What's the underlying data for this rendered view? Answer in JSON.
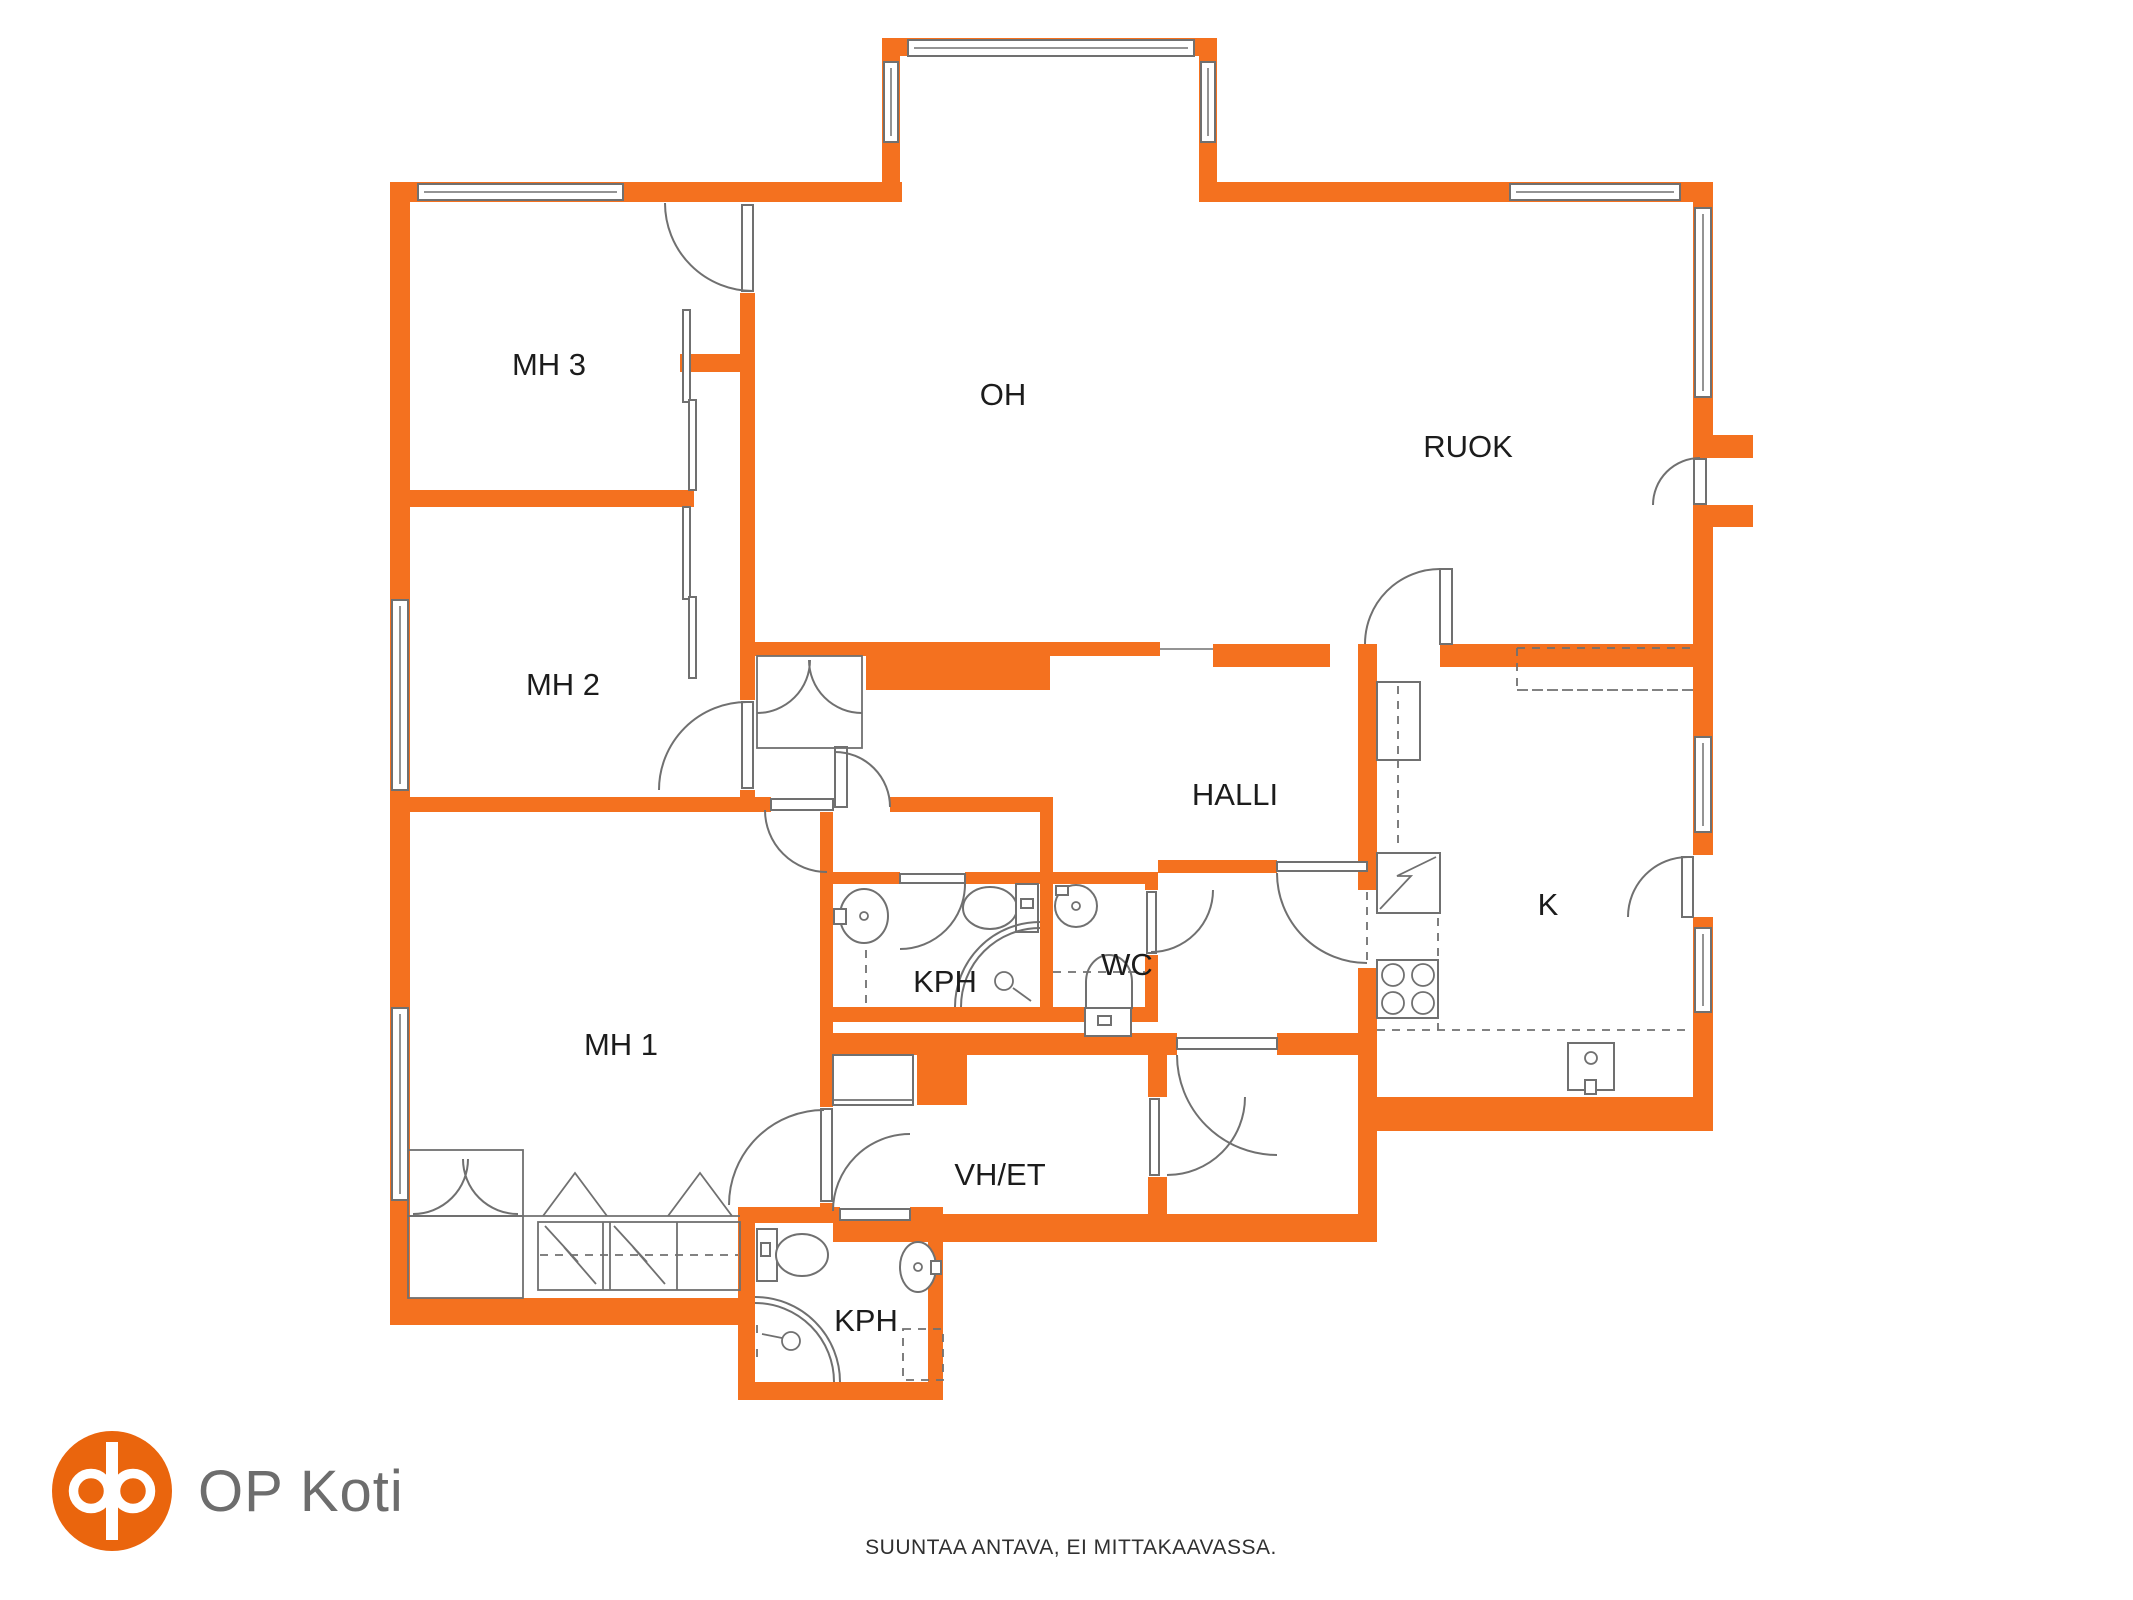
{
  "floorplan": {
    "rooms": [
      {
        "id": "mh3",
        "label": "MH 3"
      },
      {
        "id": "oh",
        "label": "OH"
      },
      {
        "id": "ruok",
        "label": "RUOK"
      },
      {
        "id": "mh2",
        "label": "MH 2"
      },
      {
        "id": "halli",
        "label": "HALLI"
      },
      {
        "id": "kph",
        "label": "KPH"
      },
      {
        "id": "wc",
        "label": "WC"
      },
      {
        "id": "k",
        "label": "K"
      },
      {
        "id": "mh1",
        "label": "MH 1"
      },
      {
        "id": "vh_et",
        "label": "VH/ET"
      },
      {
        "id": "kph2",
        "label": "KPH"
      }
    ]
  },
  "branding": {
    "logo_text": "OP Koti",
    "logo_icon": "op-monogram"
  },
  "footer": {
    "disclaimer": "SUUNTAA ANTAVA, EI MITTAKAAVASSA."
  },
  "colors": {
    "wall_orange": "#f4711f",
    "line_gray": "#707070",
    "label_black": "#1c1c1c",
    "logo_orange": "#ea650d",
    "logo_gray": "#6d6d6d"
  }
}
